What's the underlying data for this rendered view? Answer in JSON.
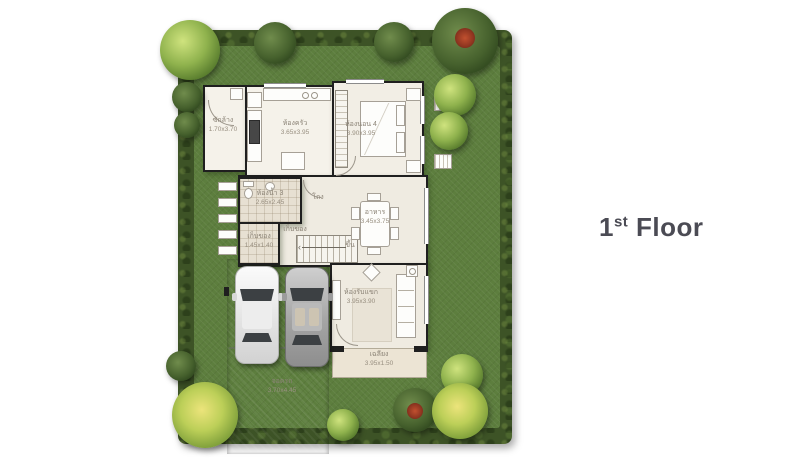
{
  "title": {
    "floor_number": "1",
    "floor_suffix": "st",
    "floor_word": "Floor"
  },
  "rooms": [
    {
      "id": "laundry",
      "label": "ซักล้าง",
      "dim": "1.70x3.70"
    },
    {
      "id": "kitchen",
      "label": "ห้องครัว",
      "dim": "3.65x3.95"
    },
    {
      "id": "bedroom-4",
      "label": "ห้องนอน 4",
      "dim": "3.90x3.95"
    },
    {
      "id": "bathroom-3",
      "label": "ห้องน้ำ 3",
      "dim": "2.65x2.45"
    },
    {
      "id": "storage",
      "label": "เก็บของ",
      "dim": "1.45x1.40"
    },
    {
      "id": "storage-under-stairs",
      "label": "เก็บของ",
      "dim": ""
    },
    {
      "id": "hall",
      "label": "โถง",
      "dim": ""
    },
    {
      "id": "stairs-up",
      "label": "ขึ้น",
      "dim": ""
    },
    {
      "id": "dining",
      "label": "อาหาร",
      "dim": "3.45x3.75"
    },
    {
      "id": "living-room",
      "label": "ห้องรับแขก",
      "dim": "3.95x3.90"
    },
    {
      "id": "terrace",
      "label": "เฉลียง",
      "dim": "3.95x1.50"
    },
    {
      "id": "parking",
      "label": "จอดรถ",
      "dim": "3.70x4.45"
    }
  ],
  "colors": {
    "lawn": "#5d7e3e",
    "hedge": "#3d5326",
    "driveway": "#bdbdbd",
    "wall": "#1f1f1f",
    "open_floor": "#efebe1",
    "title_text": "#4b4b54"
  }
}
